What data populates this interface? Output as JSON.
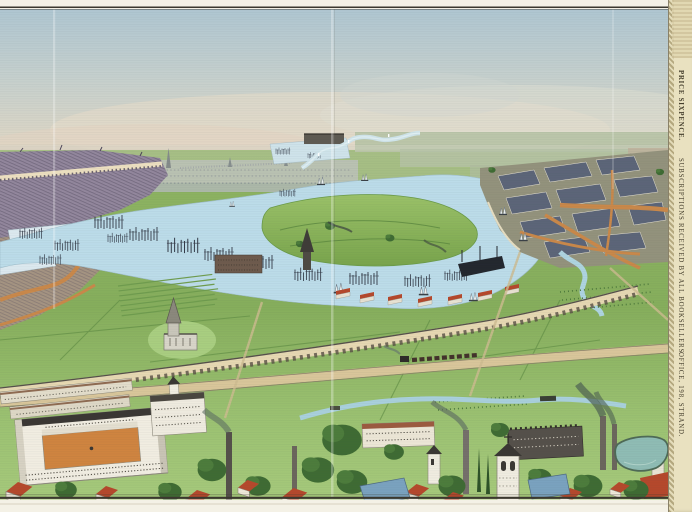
{
  "margin": {
    "price_label": "PRICE SIXPENCE.",
    "subscriptions_label": "SUBSCRIPTIONS RECEIVED BY ALL BOOKSELLERS.",
    "office_label": "OFFICE, 198, STRAND."
  },
  "palette": {
    "paper": "#f3f0e4",
    "margin_paper": "#e9e1c0",
    "margin_border": "#b4a87f",
    "ink": "#3b382f",
    "sky_top": "#afc6d1",
    "sky_horizon": "#ddd6c5",
    "distant_city": "#b0b8b2",
    "water": "#bcdce9",
    "dock_water": "#dce9ef",
    "land_green": "#8fb463",
    "lawn_green": "#a9ce80",
    "hedge_green": "#5d8a42",
    "tree_dark": "#3f6b33",
    "city_mauve": "#93879d",
    "city_tan": "#a59482",
    "road_orange": "#c9884a",
    "town_block": "#5c6578",
    "roof_red": "#b5482c",
    "roof_slate": "#7aa2bf",
    "viaduct_cream": "#e6d8b2",
    "road_tan": "#d9c69a",
    "canal_blue": "#a9d0dc",
    "building_white": "#f1ede1",
    "courtyard_orange": "#cf8440",
    "smoke_grey": "#5f6f62",
    "pond_teal": "#8fbcb4"
  }
}
